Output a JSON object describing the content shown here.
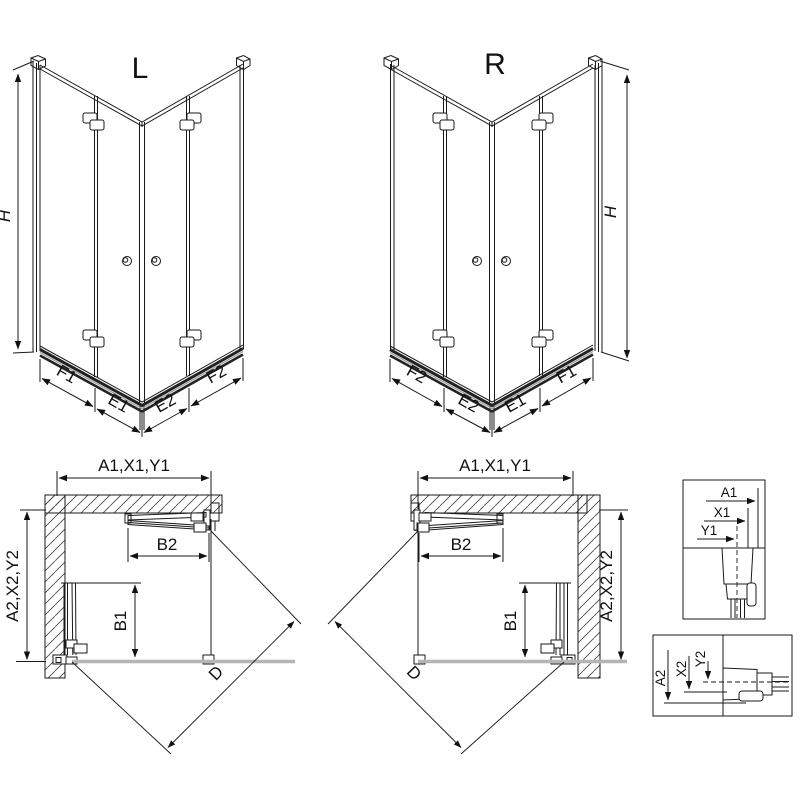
{
  "views": {
    "perspective_left": {
      "label": "L",
      "height": "H",
      "widths": [
        "F1",
        "E1",
        "E2",
        "F2"
      ]
    },
    "perspective_right": {
      "label": "R",
      "height": "H",
      "widths": [
        "F2",
        "E2",
        "E1",
        "F1"
      ]
    },
    "plan_left": {
      "width": "A1,X1,Y1",
      "depth": "A2,X2,Y2",
      "door_top": "B2",
      "door_side": "B1",
      "diagonal": "D"
    },
    "plan_right": {
      "width": "A1,X1,Y1",
      "depth": "A2,X2,Y2",
      "door_top": "B2",
      "door_side": "B1",
      "diagonal": "D"
    },
    "detail_width": {
      "labels": [
        "A1",
        "X1",
        "Y1"
      ]
    },
    "detail_depth": {
      "labels": [
        "A2",
        "X2",
        "Y2"
      ]
    }
  },
  "colors": {
    "line": "#1a1a1a",
    "rail_dark": "#222222",
    "rail_mid": "#999999",
    "tray_line": "#b5b5b5",
    "background": "#ffffff"
  }
}
